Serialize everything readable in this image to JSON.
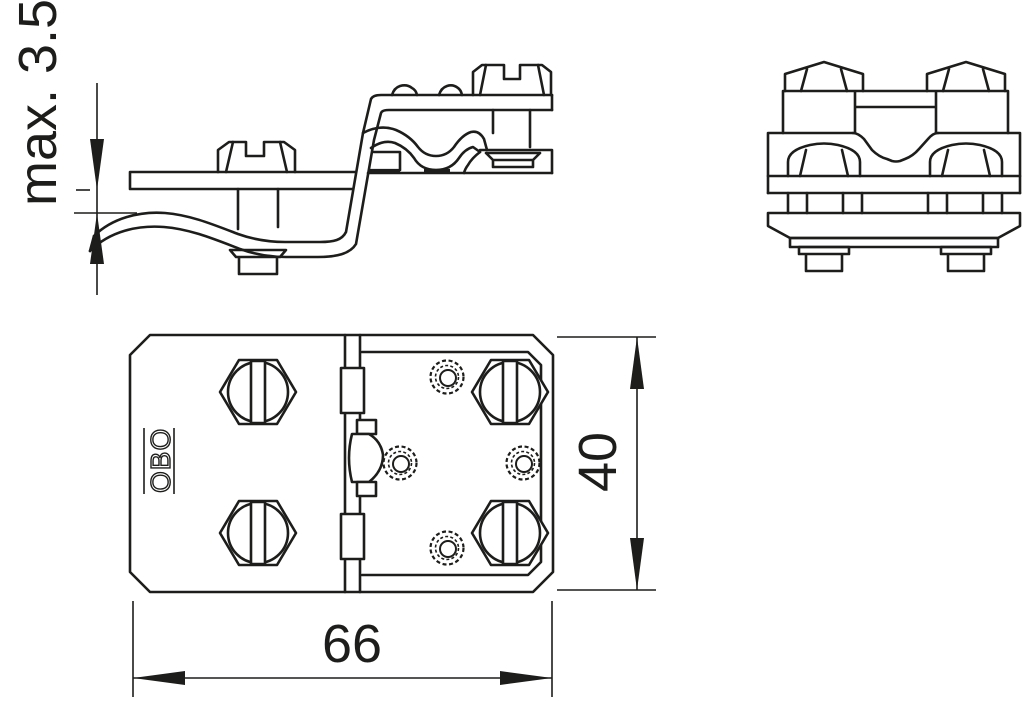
{
  "page": {
    "background": "#ffffff",
    "line_color": "#1d1d1b"
  },
  "logo": {
    "text": "OBO"
  },
  "dimensions": {
    "clamping_range": {
      "label": "max. 3.5"
    },
    "height": {
      "label": "40"
    },
    "width": {
      "label": "66"
    }
  }
}
